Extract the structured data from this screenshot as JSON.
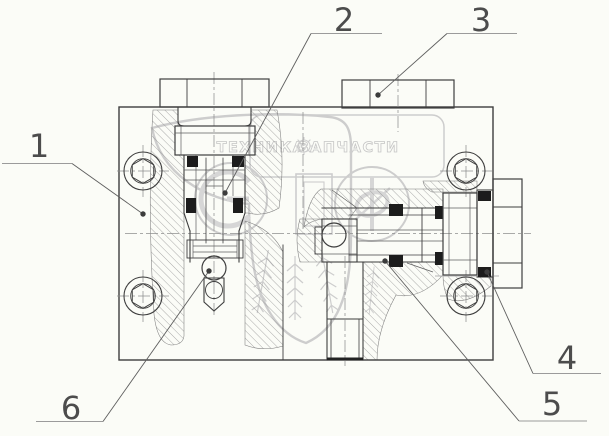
{
  "colors": {
    "background": "#fbfcf7",
    "line": "#3e3e3e",
    "seal": "#1c1c1c",
    "watermark": "#cdcdcd"
  },
  "callouts": [
    {
      "label": "1"
    },
    {
      "label": "2"
    },
    {
      "label": "3"
    },
    {
      "label": "4"
    },
    {
      "label": "5"
    },
    {
      "label": "6"
    }
  ],
  "watermark": {
    "text_left": "ТЕХНИКА",
    "text_right": "ЗАПЧАСТИ"
  },
  "icons": {
    "watermark_separator": "gear-icon",
    "watermark_plants": "wheat-icon"
  }
}
